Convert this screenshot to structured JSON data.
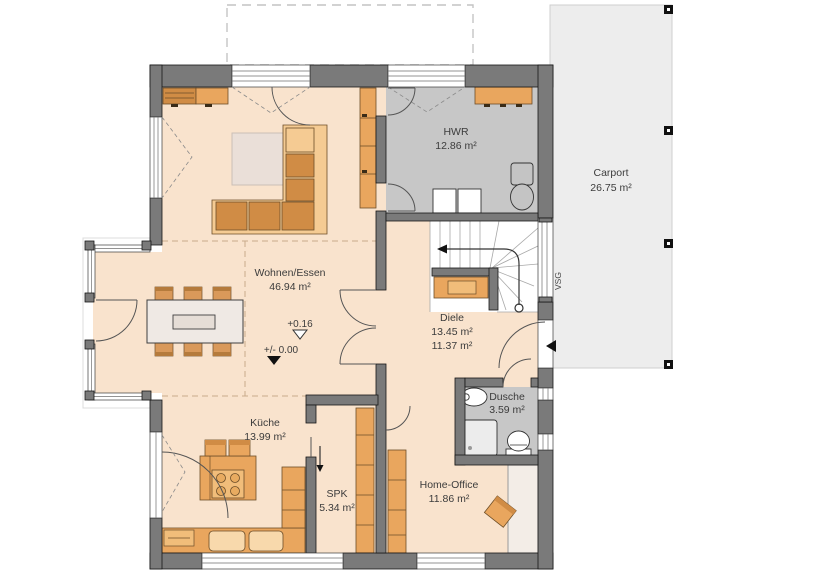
{
  "rooms": {
    "living": {
      "name": "Wohnen/Essen",
      "area": "46.94 m²"
    },
    "utility": {
      "name": "HWR",
      "area": "12.86 m²"
    },
    "hall": {
      "name": "Diele",
      "area_with": "13.45 m²",
      "area_without": "11.37 m²"
    },
    "kitchen": {
      "name": "Küche",
      "area": "13.99 m²"
    },
    "pantry": {
      "name": "SPK",
      "area": "5.34 m²"
    },
    "office": {
      "name": "Home-Office",
      "area": "11.86 m²"
    },
    "shower": {
      "name": "Dusche",
      "area": "3.59 m²"
    },
    "carport": {
      "name": "Carport",
      "area": "26.75 m²"
    }
  },
  "annotations": {
    "level_upper": "+0.16",
    "level_ground": "+/- 0.00",
    "glazing": "VSG"
  },
  "colors": {
    "wall": "#7a7a7a",
    "floor_living": "#f9e3cd",
    "floor_utility": "#c7c7c7",
    "carport": "#ededed",
    "furniture": "#e9a65e",
    "furniture_light": "#f5cb93",
    "text": "#3c3c3c"
  }
}
